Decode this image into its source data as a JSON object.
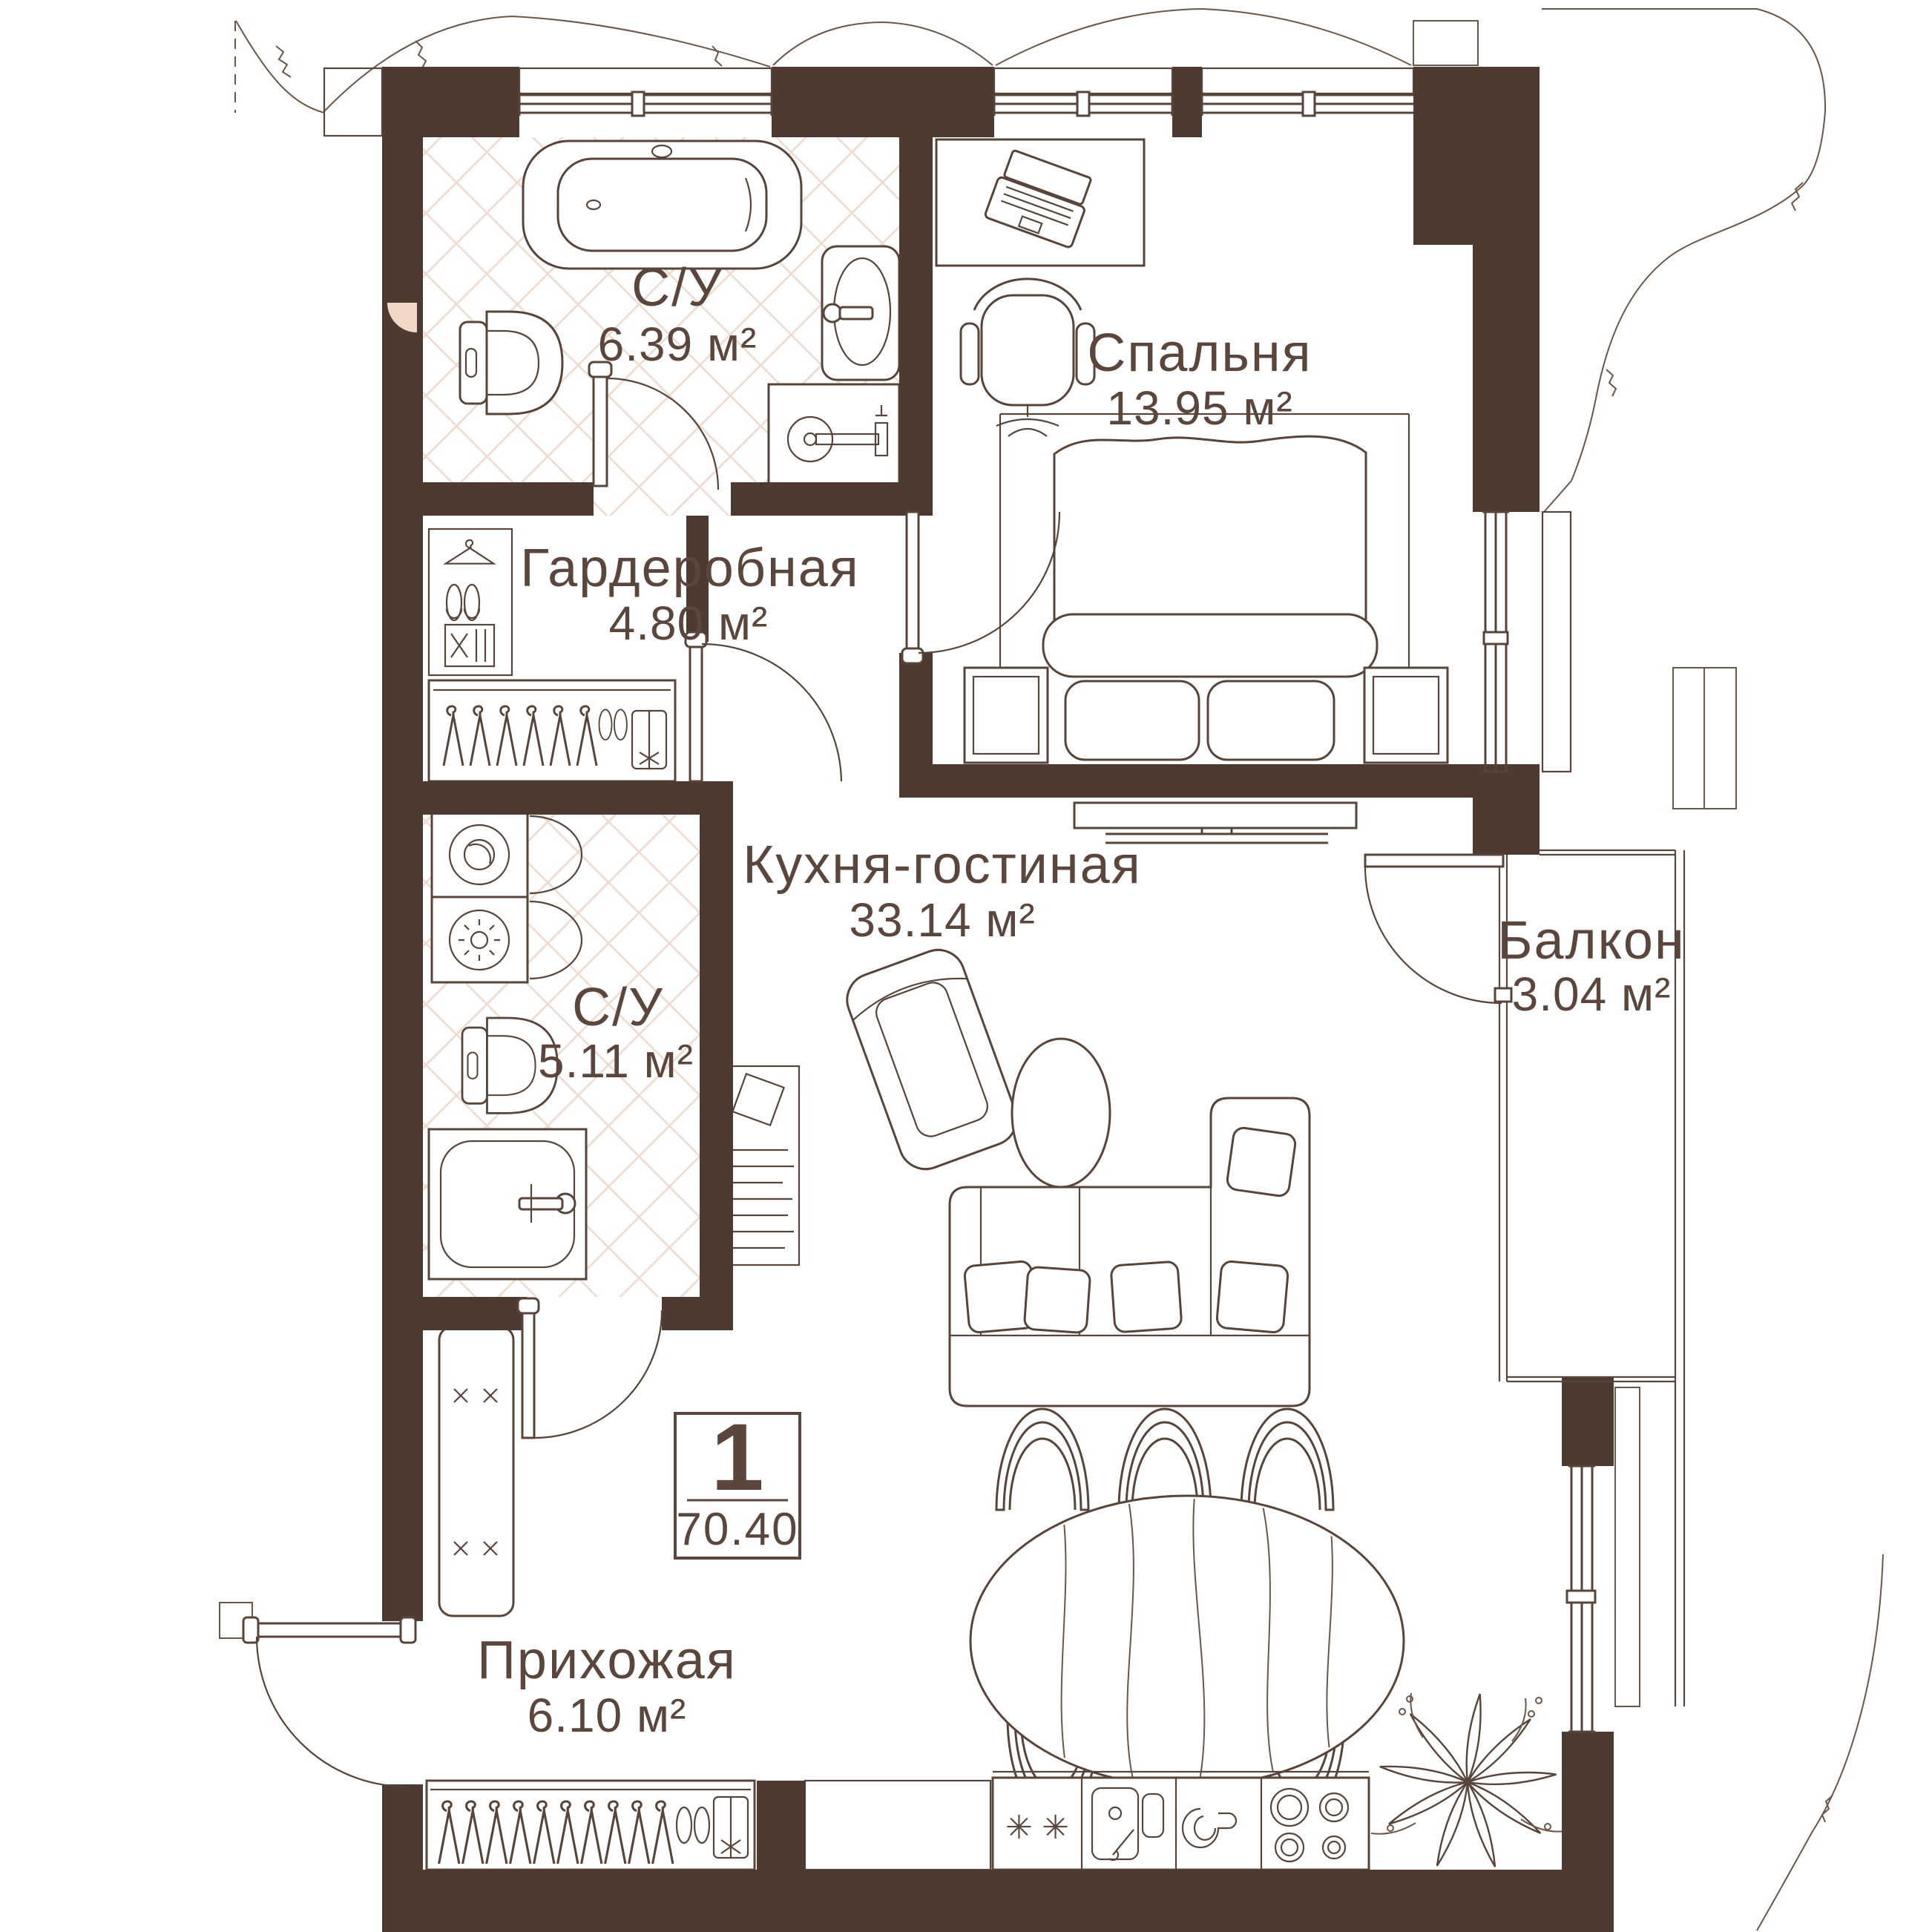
{
  "info_box": {
    "number": "1",
    "total_area": "70.40"
  },
  "rooms": {
    "bathroom_top": {
      "name": "С/У",
      "area": "6.39 м²"
    },
    "bedroom": {
      "name": "Спальня",
      "area": "13.95 м²"
    },
    "wardrobe": {
      "name": "Гардеробная",
      "area": "4.80 м²"
    },
    "kitchen_living": {
      "name": "Кухня-гостиная",
      "area": "33.14 м²"
    },
    "balcony": {
      "name": "Балкон",
      "area": "3.04 м²"
    },
    "bathroom_bottom": {
      "name": "С/У",
      "area": "5.11 м²"
    },
    "hallway": {
      "name": "Прихожая",
      "area": "6.10 м²"
    }
  },
  "fridge_marks": "✳ ✳",
  "colors": {
    "wall": "#4d3a31",
    "line": "#57443a",
    "tile": "#eedacf",
    "accent_pink": "#f2d7c8",
    "background": "#ffffff"
  },
  "icons": [
    "bathtub-icon",
    "toilet-icon",
    "sink-icon",
    "shower-icon",
    "washer-icon",
    "dryer-icon",
    "hanger-icon",
    "shoes-icon",
    "vacuum-icon",
    "storage-box-icon",
    "bed",
    "nightstand",
    "tv-console",
    "desk",
    "laptop-icon",
    "office-chair",
    "sofa",
    "armchair",
    "coffee-table",
    "dining-table",
    "dining-chair",
    "fridge-icon",
    "kitchen-sink-icon",
    "cup-icon",
    "stove-icon",
    "plant-icon",
    "bench",
    "window",
    "door-swing"
  ]
}
